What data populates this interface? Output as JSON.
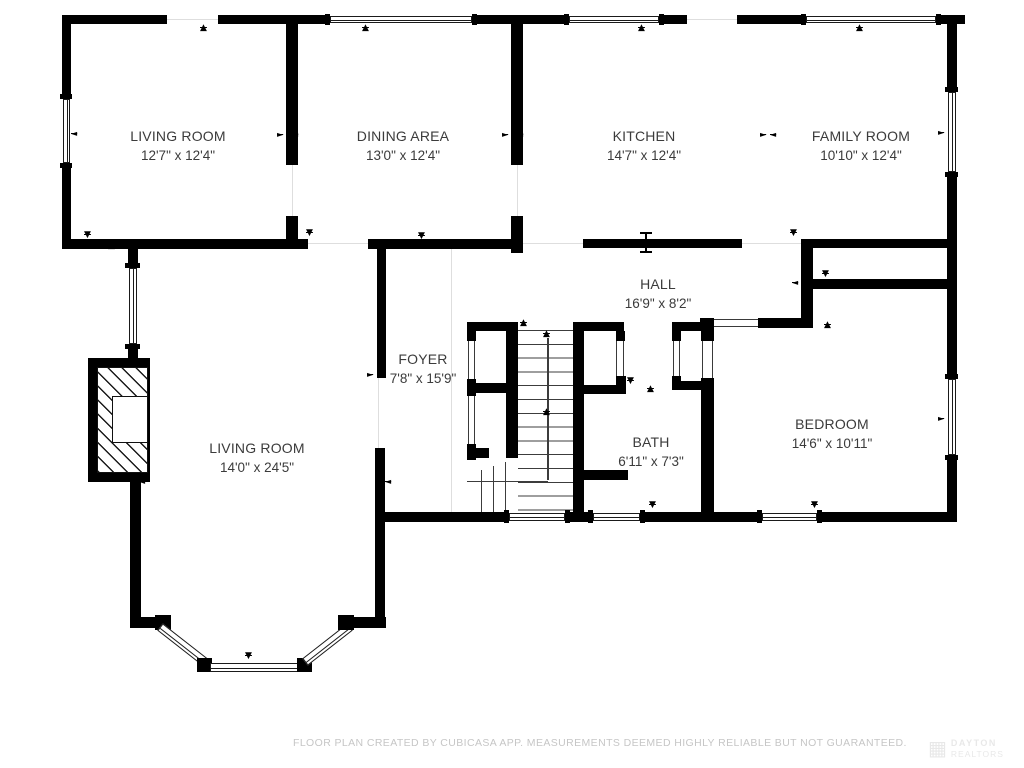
{
  "rooms": [
    {
      "id": "living-room-upper",
      "name": "LIVING ROOM",
      "dims": "12'7\" x 12'4\""
    },
    {
      "id": "dining-area",
      "name": "DINING AREA",
      "dims": "13'0\" x 12'4\""
    },
    {
      "id": "kitchen",
      "name": "KITCHEN",
      "dims": "14'7\" x 12'4\""
    },
    {
      "id": "family-room",
      "name": "FAMILY ROOM",
      "dims": "10'10\" x 12'4\""
    },
    {
      "id": "hall",
      "name": "HALL",
      "dims": "16'9\" x 8'2\""
    },
    {
      "id": "foyer",
      "name": "FOYER",
      "dims": "7'8\" x 15'9\""
    },
    {
      "id": "living-room-lower",
      "name": "LIVING ROOM",
      "dims": "14'0\" x 24'5\""
    },
    {
      "id": "bath",
      "name": "BATH",
      "dims": "6'11\" x 7'3\""
    },
    {
      "id": "bedroom",
      "name": "BEDROOM",
      "dims": "14'6\" x 10'11\""
    }
  ],
  "footer": {
    "disclaimer": "FLOOR PLAN CREATED BY CUBICASA APP. MEASUREMENTS DEEMED HIGHLY RELIABLE BUT NOT GUARANTEED."
  },
  "watermark": {
    "line1": "DAYTON",
    "line2": "REALTORS"
  },
  "colors": {
    "wall": "#000000",
    "label": "#3b3b3b",
    "muted": "#c6c6c6"
  }
}
